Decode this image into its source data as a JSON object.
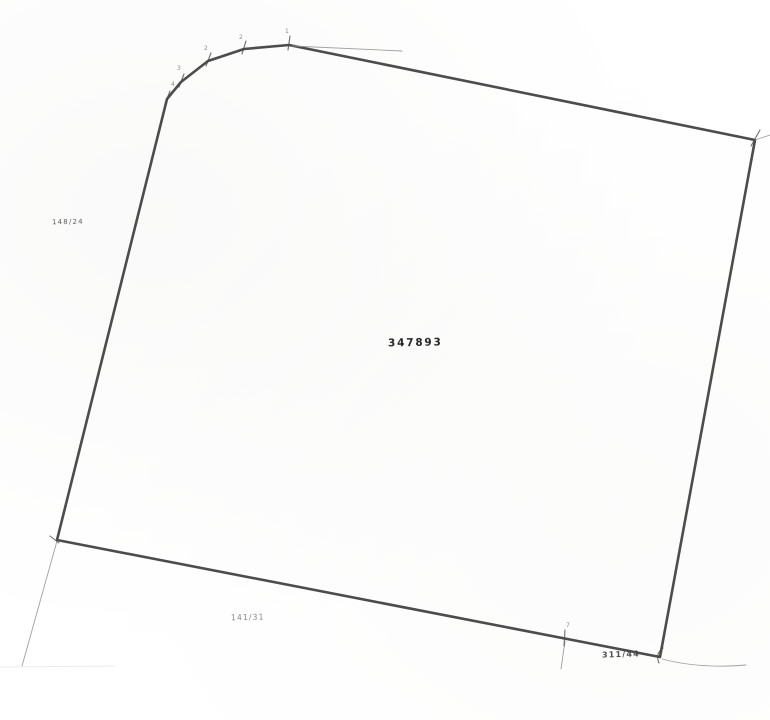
{
  "document": {
    "kind": "scanned cadastral parcel map",
    "colors": {
      "background": "#ffffff",
      "boundary": "#3d3d3d",
      "thin_line": "#8f8f8f",
      "tick": "#4a4a4a",
      "vertex_label": "#6a6a6a",
      "scan_edge": "#e9e7e4"
    }
  },
  "labels": {
    "left_parcel": "148/24",
    "main_parcel": "347893",
    "bottom_parcel": "141/31",
    "bottom_right_parcel": "311/44"
  },
  "geometry": {
    "main_polygon": [
      [
        57,
        540
      ],
      [
        167,
        99
      ],
      [
        181,
        82
      ],
      [
        208,
        61
      ],
      [
        244,
        49
      ],
      [
        289,
        45
      ],
      [
        755,
        140
      ],
      [
        660,
        657
      ]
    ],
    "thin_lines": [
      "M57,541 L22,666",
      "M662,659 Q700,669 746,665",
      "M755,140 L770,135",
      "M565,641 L561,669",
      "M292,46 L402,51",
      "M0,667 L115,666"
    ],
    "ticks": [
      "M165,104 L170,91",
      "M179,87 L184,74",
      "M206,66 L211,53",
      "M242,54 L246,41",
      "M288,50 L290,36",
      "M751,146 L760,130",
      "M565,630 L564,646",
      "M50,536 L59,543",
      "M663,648 Q655,654 659,663"
    ],
    "vertex_labels": [
      {
        "t": "4",
        "x": 171,
        "y": 86
      },
      {
        "t": "3",
        "x": 177,
        "y": 70
      },
      {
        "t": "2",
        "x": 204,
        "y": 50
      },
      {
        "t": "2",
        "x": 239,
        "y": 39
      },
      {
        "t": "1",
        "x": 285,
        "y": 33
      },
      {
        "t": "7",
        "x": 566,
        "y": 627
      }
    ]
  }
}
